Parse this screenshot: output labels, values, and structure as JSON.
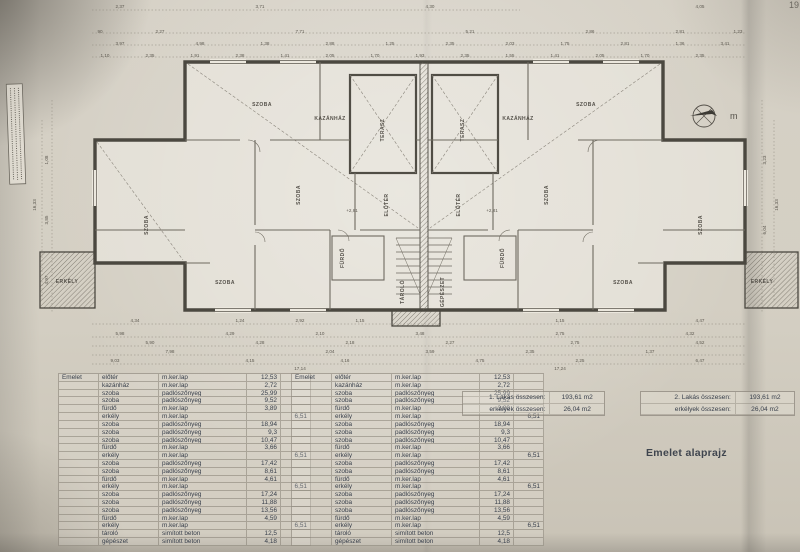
{
  "page": {
    "number": "19",
    "title": "Emelet alaprajz"
  },
  "compass": {
    "letter": "m"
  },
  "room_table": {
    "floor_label": "Emelet",
    "rows": [
      {
        "room": "előtér",
        "finish": "m.ker.lap",
        "area": "12,53",
        "balc": ""
      },
      {
        "room": "kazánház",
        "finish": "m.ker.lap",
        "area": "2,72",
        "balc": ""
      },
      {
        "room": "szoba",
        "finish": "padlószőnyeg",
        "area": "25,99",
        "balc": ""
      },
      {
        "room": "szoba",
        "finish": "padlószőnyeg",
        "area": "9,52",
        "balc": ""
      },
      {
        "room": "fürdő",
        "finish": "m.ker.lap",
        "area": "3,89",
        "balc": ""
      },
      {
        "room": "erkély",
        "finish": "m.ker.lap",
        "area": "",
        "balc": "6,51"
      },
      {
        "room": "szoba",
        "finish": "padlószőnyeg",
        "area": "18,94",
        "balc": ""
      },
      {
        "room": "szoba",
        "finish": "padlószőnyeg",
        "area": "9,3",
        "balc": ""
      },
      {
        "room": "szoba",
        "finish": "padlószőnyeg",
        "area": "10,47",
        "balc": ""
      },
      {
        "room": "fürdő",
        "finish": "m.ker.lap",
        "area": "3,66",
        "balc": ""
      },
      {
        "room": "erkély",
        "finish": "m.ker.lap",
        "area": "",
        "balc": "6,51"
      },
      {
        "room": "szoba",
        "finish": "padlószőnyeg",
        "area": "17,42",
        "balc": ""
      },
      {
        "room": "szoba",
        "finish": "padlószőnyeg",
        "area": "8,61",
        "balc": ""
      },
      {
        "room": "fürdő",
        "finish": "m.ker.lap",
        "area": "4,61",
        "balc": ""
      },
      {
        "room": "erkély",
        "finish": "m.ker.lap",
        "area": "",
        "balc": "6,51"
      },
      {
        "room": "szoba",
        "finish": "padlószőnyeg",
        "area": "17,24",
        "balc": ""
      },
      {
        "room": "szoba",
        "finish": "padlószőnyeg",
        "area": "11,88",
        "balc": ""
      },
      {
        "room": "szoba",
        "finish": "padlószőnyeg",
        "area": "13,56",
        "balc": ""
      },
      {
        "room": "fürdő",
        "finish": "m.ker.lap",
        "area": "4,59",
        "balc": ""
      },
      {
        "room": "erkély",
        "finish": "m.ker.lap",
        "area": "",
        "balc": "6,51"
      },
      {
        "room": "tároló",
        "finish": "simított beton",
        "area": "12,5",
        "balc": ""
      },
      {
        "room": "gépészet",
        "finish": "simított beton",
        "area": "4,18",
        "balc": ""
      }
    ]
  },
  "summaries": [
    {
      "l1": "1. Lakás összesen:",
      "v1": "193,61 m2",
      "l2": "erkélyek összesen:",
      "v2": "26,04 m2"
    },
    {
      "l1": "2. Lakás összesen:",
      "v1": "193,61 m2",
      "l2": "erkélyek összesen:",
      "v2": "26,04 m2"
    }
  ],
  "plan": {
    "rooms": [
      {
        "t": "SZOBA",
        "x": 148,
        "y": 225,
        "r": -90
      },
      {
        "t": "SZOBA",
        "x": 262,
        "y": 106,
        "r": 0
      },
      {
        "t": "SZOBA",
        "x": 225,
        "y": 284,
        "r": 0
      },
      {
        "t": "SZOBA",
        "x": 300,
        "y": 195,
        "r": -90
      },
      {
        "t": "FÜRDŐ",
        "x": 344,
        "y": 258,
        "r": -90
      },
      {
        "t": "ELŐTÉR",
        "x": 388,
        "y": 205,
        "r": -90
      },
      {
        "t": "KAZÁNHÁZ",
        "x": 330,
        "y": 120,
        "r": 0
      },
      {
        "t": "TERASZ",
        "x": 384,
        "y": 130,
        "r": -90
      },
      {
        "t": "TÁROLÓ",
        "x": 404,
        "y": 292,
        "r": -90
      },
      {
        "t": "ERKÉLY",
        "x": 67,
        "y": 283,
        "r": 0
      },
      {
        "t": "SZOBA",
        "x": 702,
        "y": 225,
        "r": -90
      },
      {
        "t": "SZOBA",
        "x": 586,
        "y": 106,
        "r": 0
      },
      {
        "t": "SZOBA",
        "x": 623,
        "y": 284,
        "r": 0
      },
      {
        "t": "SZOBA",
        "x": 548,
        "y": 195,
        "r": -90
      },
      {
        "t": "FÜRDŐ",
        "x": 504,
        "y": 258,
        "r": -90
      },
      {
        "t": "ELŐTÉR",
        "x": 460,
        "y": 205,
        "r": -90
      },
      {
        "t": "KAZÁNHÁZ",
        "x": 518,
        "y": 120,
        "r": 0
      },
      {
        "t": "TERASZ",
        "x": 464,
        "y": 130,
        "r": -90
      },
      {
        "t": "GÉPÉSZET",
        "x": 444,
        "y": 292,
        "r": -90
      },
      {
        "t": "ERKÉLY",
        "x": 762,
        "y": 283,
        "r": 0
      }
    ],
    "dims": [
      {
        "t": "2,37",
        "x": 120,
        "y": 8
      },
      {
        "t": "3,71",
        "x": 260,
        "y": 8
      },
      {
        "t": "4,30",
        "x": 430,
        "y": 8
      },
      {
        "t": "4,05",
        "x": 700,
        "y": 8
      },
      {
        "t": "90",
        "x": 100,
        "y": 33
      },
      {
        "t": "2,27",
        "x": 160,
        "y": 33
      },
      {
        "t": "7,71",
        "x": 300,
        "y": 33
      },
      {
        "t": "5,21",
        "x": 470,
        "y": 33
      },
      {
        "t": "2,86",
        "x": 590,
        "y": 33
      },
      {
        "t": "2,81",
        "x": 680,
        "y": 33
      },
      {
        "t": "1,23",
        "x": 738,
        "y": 33
      },
      {
        "t": "3,97",
        "x": 120,
        "y": 45
      },
      {
        "t": "4,98",
        "x": 200,
        "y": 45
      },
      {
        "t": "1,38",
        "x": 265,
        "y": 45
      },
      {
        "t": "2,88",
        "x": 330,
        "y": 45
      },
      {
        "t": "1,25",
        "x": 390,
        "y": 45
      },
      {
        "t": "2,35",
        "x": 450,
        "y": 45
      },
      {
        "t": "2,03",
        "x": 510,
        "y": 45
      },
      {
        "t": "1,75",
        "x": 565,
        "y": 45
      },
      {
        "t": "2,81",
        "x": 625,
        "y": 45
      },
      {
        "t": "1,36",
        "x": 680,
        "y": 45
      },
      {
        "t": "3,41",
        "x": 725,
        "y": 45
      },
      {
        "t": "1,10",
        "x": 105,
        "y": 57
      },
      {
        "t": "2,35",
        "x": 150,
        "y": 57
      },
      {
        "t": "1,91",
        "x": 195,
        "y": 57
      },
      {
        "t": "2,38",
        "x": 240,
        "y": 57
      },
      {
        "t": "1,41",
        "x": 285,
        "y": 57
      },
      {
        "t": "2,05",
        "x": 330,
        "y": 57
      },
      {
        "t": "1,70",
        "x": 375,
        "y": 57
      },
      {
        "t": "1,93",
        "x": 420,
        "y": 57
      },
      {
        "t": "2,35",
        "x": 465,
        "y": 57
      },
      {
        "t": "1,55",
        "x": 510,
        "y": 57
      },
      {
        "t": "1,41",
        "x": 555,
        "y": 57
      },
      {
        "t": "2,05",
        "x": 600,
        "y": 57
      },
      {
        "t": "1,70",
        "x": 645,
        "y": 57
      },
      {
        "t": "2,35",
        "x": 700,
        "y": 57
      },
      {
        "t": "4,34",
        "x": 135,
        "y": 322
      },
      {
        "t": "1,24",
        "x": 240,
        "y": 322
      },
      {
        "t": "2,92",
        "x": 300,
        "y": 322
      },
      {
        "t": "1,15",
        "x": 360,
        "y": 322
      },
      {
        "t": "1,15",
        "x": 560,
        "y": 322
      },
      {
        "t": "4,47",
        "x": 700,
        "y": 322
      },
      {
        "t": "5,98",
        "x": 120,
        "y": 335
      },
      {
        "t": "4,29",
        "x": 230,
        "y": 335
      },
      {
        "t": "2,10",
        "x": 320,
        "y": 335
      },
      {
        "t": "3,48",
        "x": 420,
        "y": 335
      },
      {
        "t": "2,75",
        "x": 560,
        "y": 335
      },
      {
        "t": "4,32",
        "x": 690,
        "y": 335
      },
      {
        "t": "5,90",
        "x": 150,
        "y": 344
      },
      {
        "t": "4,28",
        "x": 260,
        "y": 344
      },
      {
        "t": "2,18",
        "x": 350,
        "y": 344
      },
      {
        "t": "2,27",
        "x": 450,
        "y": 344
      },
      {
        "t": "2,75",
        "x": 575,
        "y": 344
      },
      {
        "t": "4,52",
        "x": 700,
        "y": 344
      },
      {
        "t": "7,98",
        "x": 170,
        "y": 353
      },
      {
        "t": "2,04",
        "x": 330,
        "y": 353
      },
      {
        "t": "3,59",
        "x": 430,
        "y": 353
      },
      {
        "t": "2,35",
        "x": 530,
        "y": 353
      },
      {
        "t": "1,37",
        "x": 650,
        "y": 353
      },
      {
        "t": "9,03",
        "x": 115,
        "y": 362
      },
      {
        "t": "4,15",
        "x": 250,
        "y": 362
      },
      {
        "t": "4,16",
        "x": 345,
        "y": 362
      },
      {
        "t": "4,75",
        "x": 480,
        "y": 362
      },
      {
        "t": "2,25",
        "x": 580,
        "y": 362
      },
      {
        "t": "6,47",
        "x": 700,
        "y": 362
      },
      {
        "t": "17,14",
        "x": 300,
        "y": 370
      },
      {
        "t": "17,24",
        "x": 560,
        "y": 370
      },
      {
        "t": "1,08",
        "x": 48,
        "y": 160,
        "r": -90
      },
      {
        "t": "3,85",
        "x": 48,
        "y": 220,
        "r": -90
      },
      {
        "t": "16,33",
        "x": 36,
        "y": 205,
        "r": -90
      },
      {
        "t": "4,97",
        "x": 48,
        "y": 280,
        "r": -90
      },
      {
        "t": "3,23",
        "x": 766,
        "y": 160,
        "r": -90
      },
      {
        "t": "6,04",
        "x": 766,
        "y": 230,
        "r": -90
      },
      {
        "t": "16,33",
        "x": 778,
        "y": 205,
        "r": -90
      },
      {
        "t": "+2,81",
        "x": 352,
        "y": 212
      },
      {
        "t": "+2,81",
        "x": 492,
        "y": 212
      }
    ]
  }
}
